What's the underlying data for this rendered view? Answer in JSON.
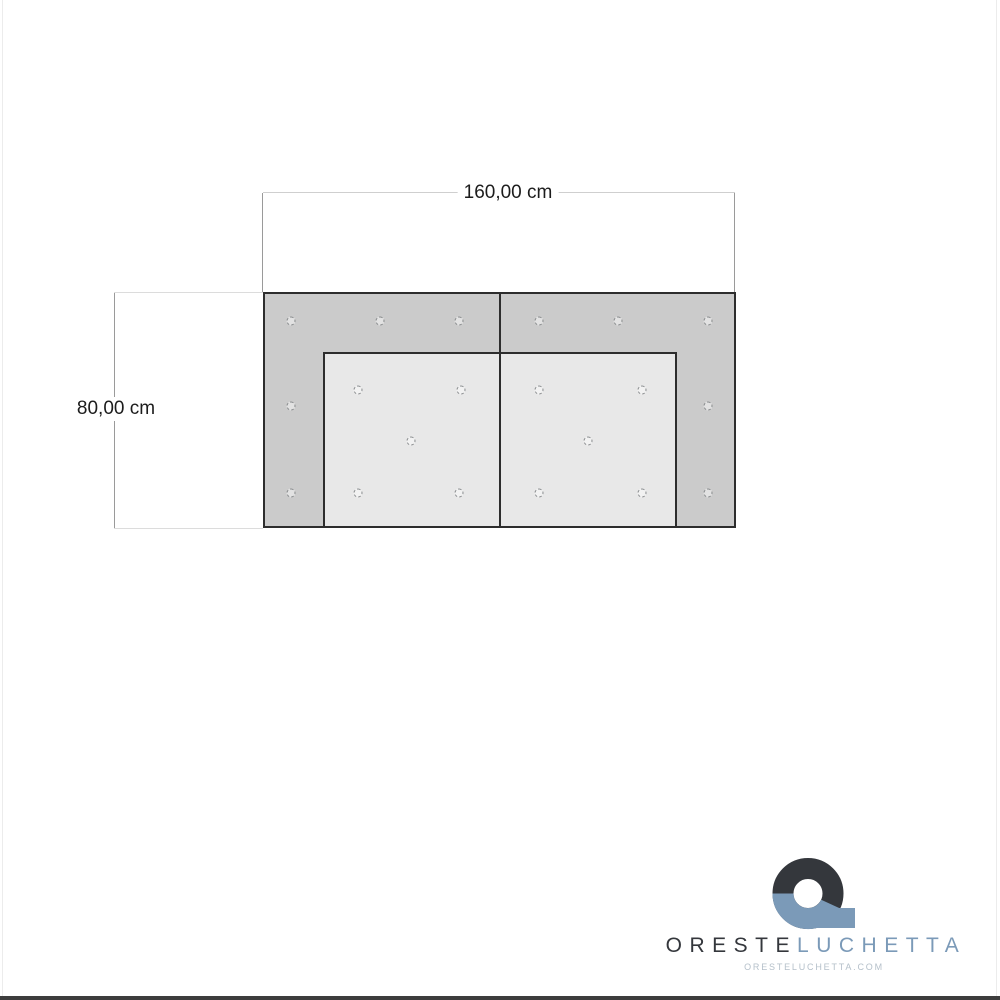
{
  "dimensions": {
    "width_label": "160,00 cm",
    "height_label": "80,00 cm"
  },
  "panel": {
    "outer_fill": "#cbcbcb",
    "inner_fill": "#e8e8e8",
    "border_color": "#2d2d2d",
    "holes": [
      [
        291,
        321
      ],
      [
        380,
        321
      ],
      [
        459,
        321
      ],
      [
        539,
        321
      ],
      [
        618,
        321
      ],
      [
        708,
        321
      ],
      [
        358,
        390
      ],
      [
        461,
        390
      ],
      [
        539,
        390
      ],
      [
        642,
        390
      ],
      [
        291,
        406
      ],
      [
        708,
        406
      ],
      [
        411,
        441
      ],
      [
        588,
        441
      ],
      [
        291,
        493
      ],
      [
        358,
        493
      ],
      [
        459,
        493
      ],
      [
        539,
        493
      ],
      [
        642,
        493
      ],
      [
        708,
        493
      ]
    ]
  },
  "logo": {
    "name_primary": "ORESTE",
    "name_secondary": "LUCHETTA",
    "website": "ORESTELUCHETTA.COM",
    "color_dark": "#34373c",
    "color_blue": "#7b9ab8"
  }
}
